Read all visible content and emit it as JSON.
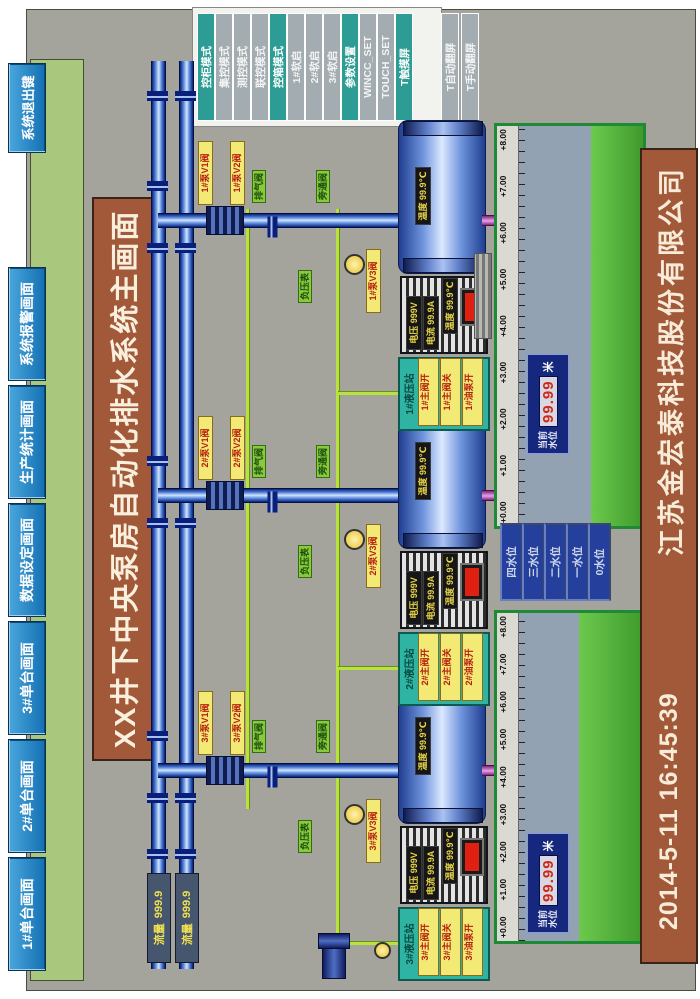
{
  "nav": {
    "buttons": [
      "1#单台画面",
      "2#单台画面",
      "3#单台画面",
      "数据设定画面",
      "生产统计画面",
      "系统报警画面"
    ],
    "exit_label": "系统退出键"
  },
  "title": "XX井下中央泵房自动化排水系统主画面",
  "mode_panel": {
    "buttons": [
      {
        "label": "控柜模式"
      },
      {
        "label": "集控模式"
      },
      {
        "label": "测控模式"
      },
      {
        "label": "联控模式"
      },
      {
        "label": "控箱模式"
      },
      {
        "label": "1#软启"
      },
      {
        "label": "2#软启"
      },
      {
        "label": "3#软启"
      },
      {
        "label": "参数设置"
      },
      {
        "label": "WINCC_SET"
      },
      {
        "label": "TOUCH_SET"
      },
      {
        "label": "T触摸屏"
      },
      {
        "label": "T自动翻屏"
      },
      {
        "label": "T手动翻屏"
      }
    ]
  },
  "footer": {
    "datetime": "2014-5-11  16:45:39",
    "company": "江苏金宏泰科技股份有限公司"
  },
  "mains": {
    "flow1": {
      "label": "流量",
      "value": "999.9"
    },
    "flow2": {
      "label": "流量",
      "value": "999.9"
    }
  },
  "units": [
    {
      "id": "3#",
      "valves": {
        "v1": "3#泵V1阀",
        "v2": "3#泵V2阀",
        "v3": "3#泵V3阀"
      },
      "green_labels": {
        "vent": "排气阀",
        "bypass": "旁通阀",
        "vacuum": "负压表"
      },
      "motor": {
        "voltage": "电压 999V",
        "current": "电流 99.9A",
        "temp": "温度 99.9℃"
      },
      "pump": {
        "temp": "温度 99.9℃"
      },
      "hydraulic": {
        "title": "3#液压站",
        "buttons": [
          "3#主阀开",
          "3#主阀关",
          "3#油泵开"
        ]
      }
    },
    {
      "id": "2#",
      "valves": {
        "v1": "2#泵V1阀",
        "v2": "2#泵V2阀",
        "v3": "2#泵V3阀"
      },
      "green_labels": {
        "vent": "排气阀",
        "bypass": "旁通阀",
        "vacuum": "负压表"
      },
      "motor": {
        "voltage": "电压 999V",
        "current": "电流 99.9A",
        "temp": "温度 99.9℃"
      },
      "pump": {
        "temp": "温度 99.9℃"
      },
      "hydraulic": {
        "title": "2#液压站",
        "buttons": [
          "2#主阀开",
          "2#主阀关",
          "2#油泵开"
        ]
      }
    },
    {
      "id": "1#",
      "valves": {
        "v1": "1#泵V1阀",
        "v2": "1#泵V2阀",
        "v3": "1#泵V3阀"
      },
      "green_labels": {
        "vent": "排气阀",
        "bypass": "旁通阀",
        "vacuum": "负压表"
      },
      "motor": {
        "voltage": "电压 999V",
        "current": "电流 99.9A",
        "temp": "温度 99.9℃"
      },
      "pump": {
        "temp": "温度 99.9℃"
      },
      "hydraulic": {
        "title": "1#液压站",
        "buttons": [
          "1#主阀开",
          "1#主阀关",
          "1#油泵开"
        ]
      }
    }
  ],
  "sumps": [
    {
      "scale": [
        "+0.00",
        "+1.00",
        "+2.00",
        "+3.00",
        "+4.00",
        "+5.00",
        "+6.00",
        "+7.00",
        "+8.00"
      ],
      "level": {
        "caption1": "当前",
        "caption2": "水位",
        "value": "99.99",
        "unit": "米"
      }
    },
    {
      "scale": [
        "+0.00",
        "+1.00",
        "+2.00",
        "+3.00",
        "+4.00",
        "+5.00",
        "+6.00",
        "+7.00",
        "+8.00"
      ],
      "level": {
        "caption1": "当前",
        "caption2": "水位",
        "value": "99.99",
        "unit": "米"
      }
    }
  ],
  "level_buttons": [
    "四水位",
    "三水位",
    "二水位",
    "一水位",
    "0水位"
  ],
  "colors": {
    "nav_green": "#a9c87e",
    "button_blue": "#1470b2",
    "bar_brown": "#a2593a",
    "mode_teal": "#2d9c94",
    "pipe_blue": "#2a52b0",
    "pipe_green": "#b6e43c",
    "pipe_magenta": "#d883d8",
    "water_green": "#55b23e",
    "label_yellow": "#f2ea74"
  }
}
